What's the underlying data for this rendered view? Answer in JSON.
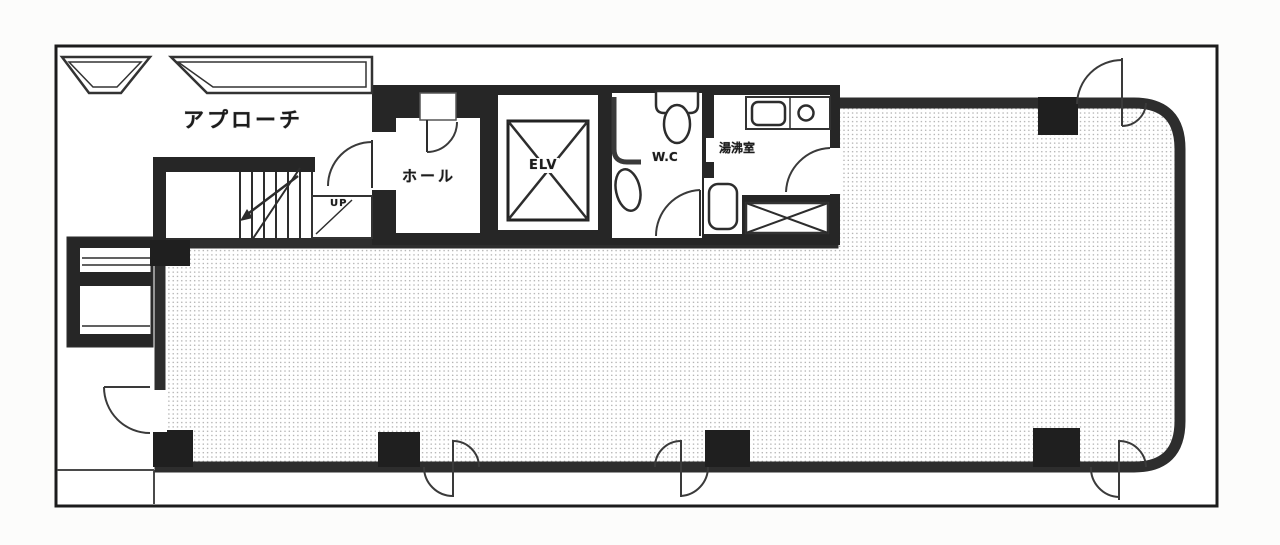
{
  "document": {
    "kind": "building-floor-plan",
    "rooms": {
      "approach": "アプローチ",
      "hall": "ホール",
      "elevator": "ELV",
      "toilet": "W.C",
      "kitchenette": "湯沸室",
      "stairs_direction": "UP"
    },
    "colors": {
      "wall": "#262626",
      "ink": "#2d2d2d",
      "paper": "#fcfcfb",
      "floor_dots": "#ababab"
    }
  }
}
